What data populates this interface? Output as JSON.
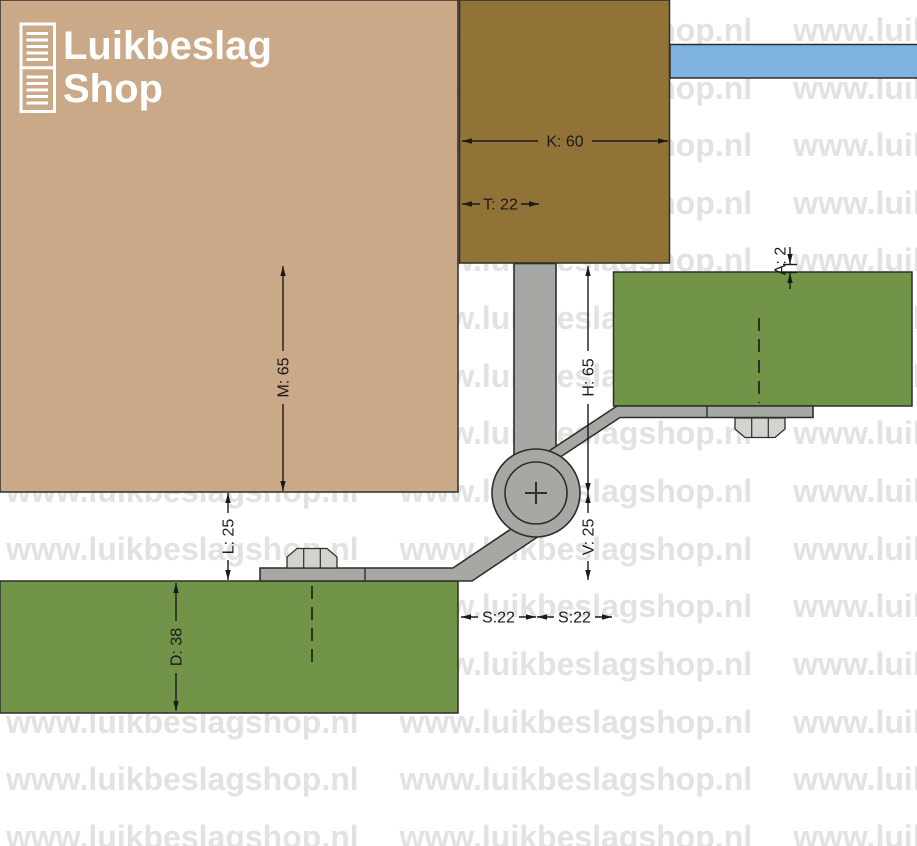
{
  "logo": {
    "line1": "Luikbeslag",
    "line2": "Shop"
  },
  "watermark": {
    "line": "www.luikbeslagshop.nl www.luikbeslagshop.nl www.luikbeslagshop.nl"
  },
  "dimensions": {
    "k": "K: 60",
    "t": "T: 22",
    "m": "M: 65",
    "h": "H: 65",
    "a": "A: 2",
    "v": "V: 25",
    "l": "L: 25",
    "d": "D: 38",
    "s1": "S:22",
    "s2": "S:22"
  },
  "colors": {
    "wall": "#CAA988",
    "beam": "#917338",
    "glass": "#7FB3DF",
    "shutter": "#719448",
    "steel": "#A5A8A3",
    "bolt": "#D2D3CF",
    "outline": "#2E2E2A",
    "dim": "#1A1A1A",
    "watermark": "#E2E2E2",
    "logowhite": "#FFFFFF"
  }
}
